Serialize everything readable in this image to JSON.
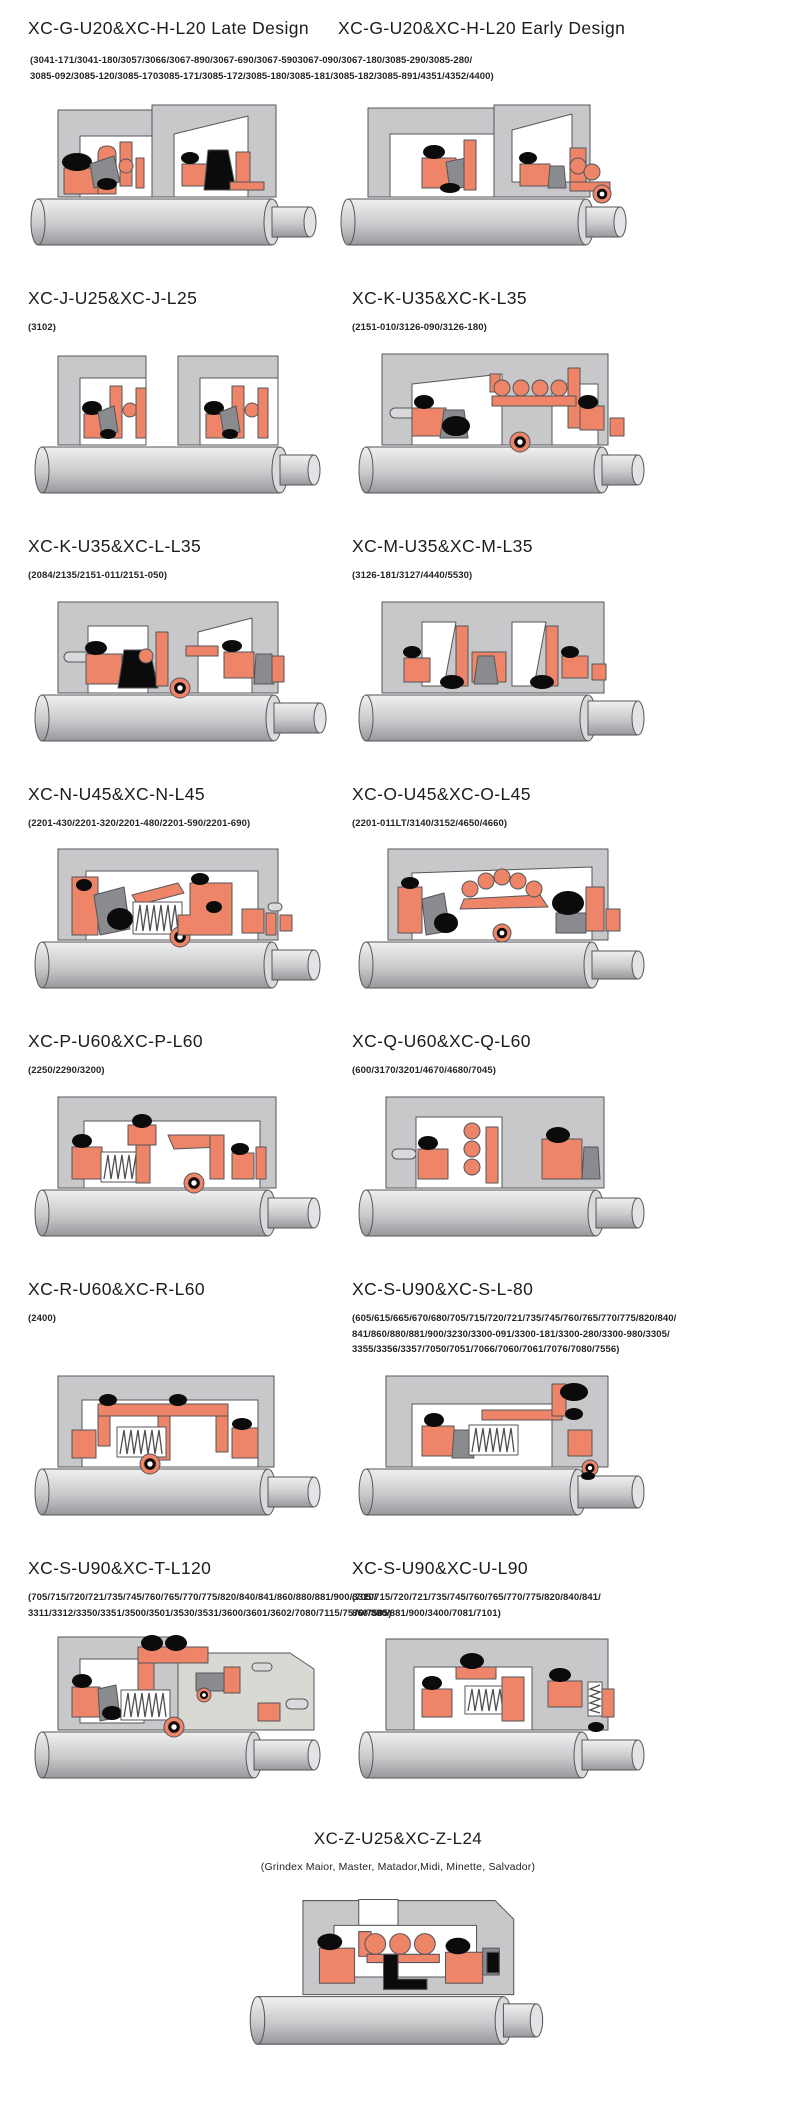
{
  "header": {
    "left_title": "XC-G-U20&XC-H-L20 Late Design",
    "right_title": "XC-G-U20&XC-H-L20 Early Design",
    "subtitle": "(3041-171/3041-180/3057/3066/3067-890/3067-690/3067-5903067-090/3067-180/3085-290/3085-280/\n3085-092/3085-120/3085-1703085-171/3085-172/3085-180/3085-181/3085-182/3085-891/4351/4352/4400)",
    "left_diagram": {
      "name": "seal-cross-section-diagram",
      "variant": 1
    },
    "right_diagram": {
      "name": "seal-cross-section-diagram",
      "variant": 2
    }
  },
  "sections": [
    {
      "title": "XC-J-U25&XC-J-L25",
      "subtitle": "(3102)",
      "diagram": "seal-cross-section-diagram",
      "variant": 3
    },
    {
      "title": "XC-K-U35&XC-K-L35",
      "subtitle": "(2151-010/3126-090/3126-180)",
      "diagram": "seal-cross-section-diagram",
      "variant": 4
    },
    {
      "title": "XC-K-U35&XC-L-L35",
      "subtitle": "(2084/2135/2151-011/2151-050)",
      "diagram": "seal-cross-section-diagram",
      "variant": 5
    },
    {
      "title": "XC-M-U35&XC-M-L35",
      "subtitle": "(3126-181/3127/4440/5530)",
      "diagram": "seal-cross-section-diagram",
      "variant": 6
    },
    {
      "title": "XC-N-U45&XC-N-L45",
      "subtitle": "(2201-430/2201-320/2201-480/2201-590/2201-690)",
      "diagram": "seal-cross-section-diagram",
      "variant": 7
    },
    {
      "title": "XC-O-U45&XC-O-L45",
      "subtitle": "(2201-011LT/3140/3152/4650/4660)",
      "diagram": "seal-cross-section-diagram",
      "variant": 8
    },
    {
      "title": "XC-P-U60&XC-P-L60",
      "subtitle": "(2250/2290/3200)",
      "diagram": "seal-cross-section-diagram",
      "variant": 9
    },
    {
      "title": "XC-Q-U60&XC-Q-L60",
      "subtitle": "(600/3170/3201/4670/4680/7045)",
      "diagram": "seal-cross-section-diagram",
      "variant": 10
    },
    {
      "title": "XC-R-U60&XC-R-L60",
      "subtitle": "(2400)",
      "diagram": "seal-cross-section-diagram",
      "variant": 11
    },
    {
      "title": "XC-S-U90&XC-S-L-80",
      "subtitle": "(605/615/665/670/680/705/715/720/721/735/745/760/765/770/775/820/840/\n841/860/880/881/900/3230/3300-091/3300-181/3300-280/3300-980/3305/\n3355/3356/3357/7050/7051/7066/7060/7061/7076/7080/7556)",
      "diagram": "seal-cross-section-diagram",
      "variant": 12
    },
    {
      "title": "XC-S-U90&XC-T-L120",
      "subtitle": "(705/715/720/721/735/745/760/765/770/775/820/840/841/860/880/881/900/3310/\n3311/3312/3350/3351/3500/3501/3530/3531/3600/3601/3602/7080/7115/7570/7585)",
      "diagram": "seal-cross-section-diagram",
      "variant": 13
    },
    {
      "title": "XC-S-U90&XC-U-L90",
      "subtitle": "(705/715/720/721/735/745/760/765/770/775/820/840/841/\n860/880/881/900/3400/7081/7101)",
      "diagram": "seal-cross-section-diagram",
      "variant": 14
    }
  ],
  "footer": {
    "title": "XC-Z-U25&XC-Z-L24",
    "subtitle": "(Grindex  Maior, Master, Matador,Midi, Minette, Salvador)",
    "diagram": {
      "name": "seal-cross-section-diagram",
      "variant": 15
    }
  },
  "colors": {
    "seal_orange": "#ee8468",
    "housing_gray": "#c8c8ca",
    "component_gray": "#8a8b8f",
    "elastomer_black": "#0b0b0b",
    "shaft_light": "#f0f0f1",
    "shaft_dark": "#97989b",
    "angular_block_gray": "#d9d9d4"
  }
}
